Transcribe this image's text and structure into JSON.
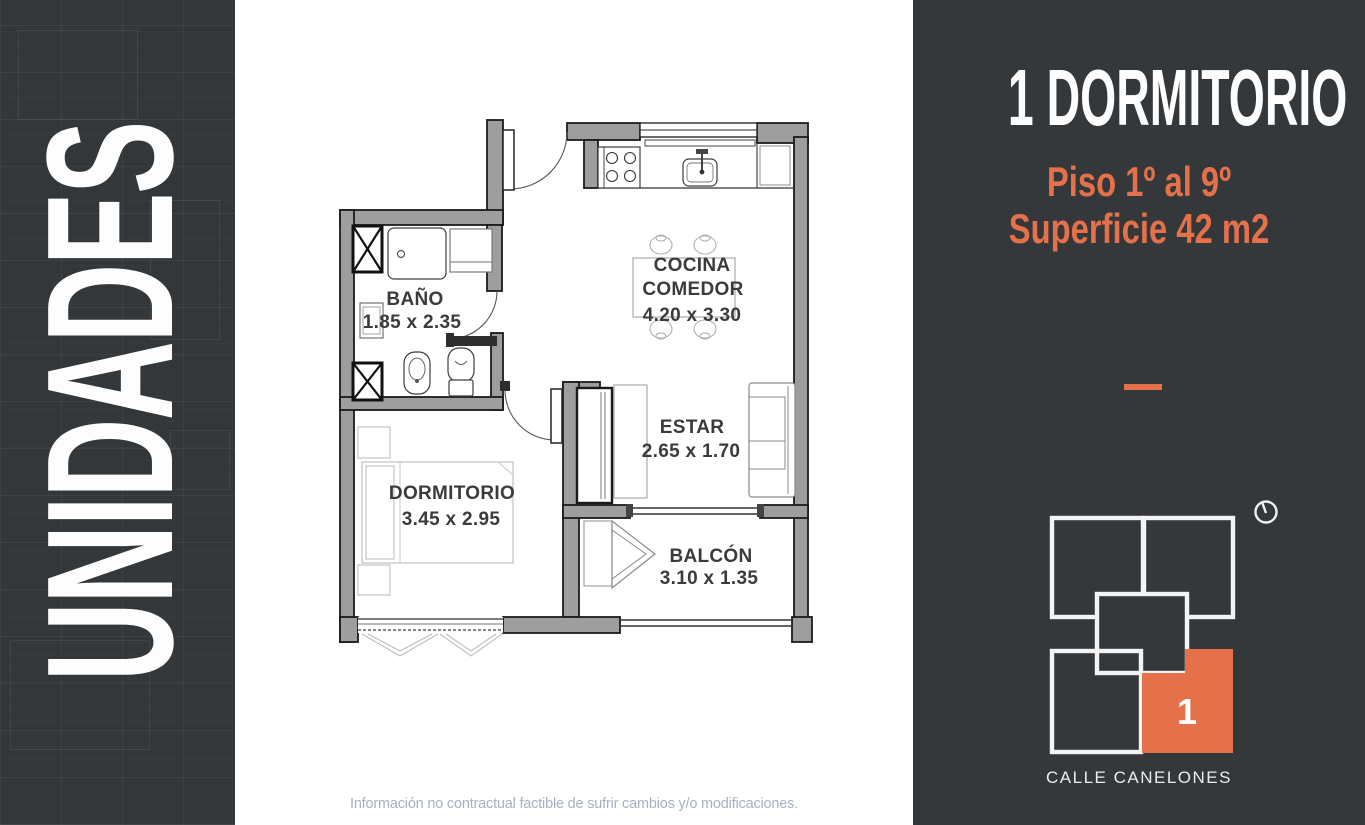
{
  "left_panel": {
    "title": "UNIDADES"
  },
  "plan": {
    "rooms": [
      {
        "name": "BAÑO",
        "dims": "1.85 x 2.35"
      },
      {
        "name": "COCINA",
        "name2": "COMEDOR",
        "dims": "4.20 x 3.30"
      },
      {
        "name": "ESTAR",
        "dims": "2.65 x 1.70"
      },
      {
        "name": "DORMITORIO",
        "dims": "3.45 x 2.95"
      },
      {
        "name": "BALCÓN",
        "dims": "3.10 x 1.35"
      }
    ],
    "wall_color": "#9e9e9e"
  },
  "footer": {
    "disclaimer": "Información no contractual factible de sufrir cambios y/o modificaciones."
  },
  "right_panel": {
    "title": "1 DORMITORIO",
    "subtitle_line1": "Piso 1º al 9º",
    "subtitle_line2": "Superficie 42 m2",
    "accent_color": "#e5714b",
    "background_color": "#34383b",
    "locator": {
      "unit_number": "1",
      "street_label": "CALLE CANELONES",
      "icons": [
        "north-indicator-icon"
      ]
    }
  }
}
